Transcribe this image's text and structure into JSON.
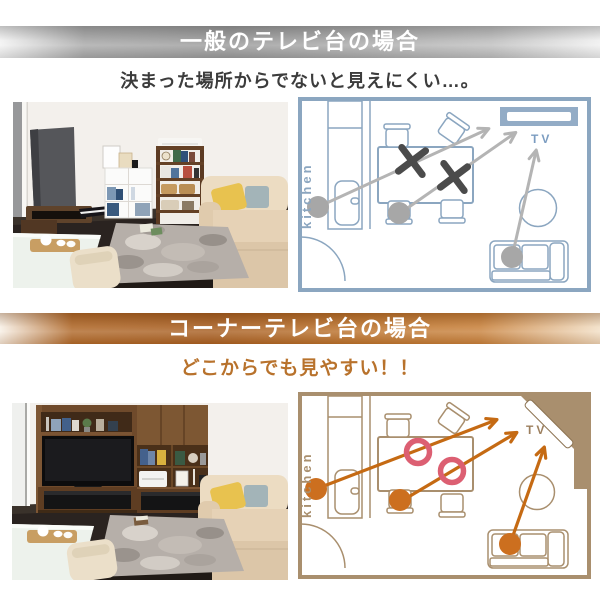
{
  "page": {
    "background": "#ffffff"
  },
  "sections": [
    {
      "id": "standard-tv-stand",
      "banner_title": "一般のテレビ台の場合",
      "subtitle": "決まった場所からでないと見えにくい…。",
      "accent_color": "#8ba6c0",
      "arrow_color": "#b4b4b4",
      "dot_color": "#a7a7a7",
      "mark": "x",
      "mark_color": "#4b4b4b",
      "plan": {
        "kitchen_label": "kitchen",
        "tv_label": "TV"
      }
    },
    {
      "id": "corner-tv-stand",
      "banner_title": "コーナーテレビ台の場合",
      "subtitle": "どこからでも見やすい！！",
      "accent_color": "#a98f6e",
      "arrow_color": "#c56a13",
      "dot_color": "#cc6f1f",
      "mark": "circle",
      "mark_color": "#dc5f72",
      "plan": {
        "kitchen_label": "kitchen",
        "tv_label": "TV"
      }
    }
  ]
}
